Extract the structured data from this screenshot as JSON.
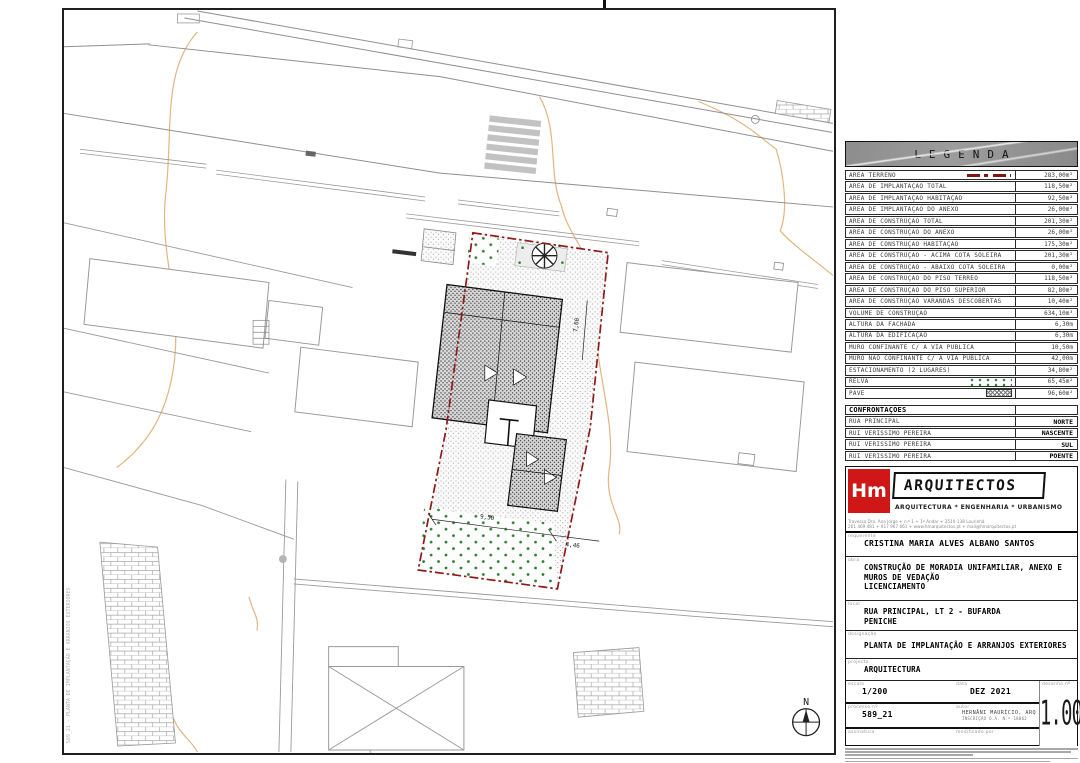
{
  "legend": {
    "title": "LEGENDA",
    "rows": [
      {
        "label": "ÁREA TERRENO",
        "value": "283,00m²",
        "symbol": "red-dashdot"
      },
      {
        "label": "ÁREA DE IMPLANTAÇÃO TOTAL",
        "value": "118,50m²"
      },
      {
        "label": "ÁREA DE IMPLANTAÇÃO HABITAÇÃO",
        "value": "92,50m²"
      },
      {
        "label": "ÁREA DE IMPLANTAÇÃO DO ANEXO",
        "value": "26,00m²"
      },
      {
        "label": "ÁREA DE CONSTRUÇÃO TOTAL",
        "value": "201,30m²"
      },
      {
        "label": "ÁREA DE CONSTRUÇÃO DO ANEXO",
        "value": "26,00m²"
      },
      {
        "label": "ÁREA DE CONSTRUÇÃO HABITAÇÃO",
        "value": "175,30m²"
      },
      {
        "label": "ÁREA DE CONSTRUÇÃO - ACIMA COTA SOLEIRA",
        "value": "201,30m²"
      },
      {
        "label": "ÁREA DE CONSTRUÇÃO - ABAIXO COTA SOLEIRA",
        "value": "0,00m²"
      },
      {
        "label": "ÁREA DE CONSTRUÇÃO DO PISO TÉRREO",
        "value": "118,50m²"
      },
      {
        "label": "ÁREA DE CONSTRUÇÃO DO PISO SUPERIOR",
        "value": "82,80m²"
      },
      {
        "label": "ÁREA DE CONSTRUÇÃO VARANDAS DESCOBERTAS",
        "value": "10,40m²"
      },
      {
        "label": "VOLUME DE CONSTRUÇÃO",
        "value": "634,10m³"
      },
      {
        "label": "ALTURA DA FACHADA",
        "value": "6,30m"
      },
      {
        "label": "ALTURA DA EDIFICAÇÃO",
        "value": "6,30m"
      },
      {
        "label": "MURO CONFINANTE C/ A VIA PÚBLICA",
        "value": "10,50m"
      },
      {
        "label": "MURO NÃO CONFINANTE C/ A VIA PÚBLICA",
        "value": "42,00m"
      },
      {
        "label": "ESTACIONAMENTO (2 LUGARES)",
        "value": "34,80m²"
      },
      {
        "label": "RELVA",
        "value": "65,45m²",
        "symbol": "grass-dots"
      },
      {
        "label": "PAVÊ",
        "value": "96,60m²",
        "symbol": "pave-hatch"
      }
    ]
  },
  "confrontacoes": {
    "title": "CONFRONTAÇÕES",
    "rows": [
      {
        "label": "RUA PRINCIPAL",
        "value": "NORTE"
      },
      {
        "label": "RUI VERISSIMO PEREIRA",
        "value": "NASCENTE"
      },
      {
        "label": "RUI VERISSIMO PEREIRA",
        "value": "SUL"
      },
      {
        "label": "RUI VERISSIMO PEREIRA",
        "value": "POENTE"
      }
    ]
  },
  "firm": {
    "logo_initials": "Hm",
    "name": "ARQUITECTOS",
    "tagline": "ARQUITECTURA * ENGENHARIA * URBANISMO",
    "address_line1": "Travessa Dra. Ana Jorge + n.º 1 + 1º Andar + 2510-138 Lourinhã",
    "address_line2": "261 469 481 + 917 967 661 + www.hmarquitectos.pt + mail@hmarquitectos.pt"
  },
  "title_block": {
    "labels": {
      "requerente": "requerente",
      "obra": "obra",
      "local": "local",
      "designacao": "designação",
      "projecto": "projecto",
      "escala": "escala",
      "data": "data",
      "desenho": "desenho nº",
      "processo": "processo nº",
      "autor": "autor",
      "assinatura": "assinatura",
      "modificado": "modificado por"
    },
    "requerente": "CRISTINA MARIA ALVES ALBANO SANTOS",
    "obra_lines": [
      "CONSTRUÇÃO DE MORADIA UNIFAMILIAR, ANEXO E",
      "MUROS DE VEDAÇÃO",
      "LICENCIAMENTO"
    ],
    "local_lines": [
      "RUA PRINCIPAL, LT 2 - BUFARDA",
      "PENICHE"
    ],
    "designacao": "PLANTA DE IMPLANTAÇÃO E ARRANJOS EXTERIORES",
    "projecto": "ARQUITECTURA",
    "escala": "1/200",
    "data": "DEZ 2021",
    "processo": "589_21",
    "autor_lines": [
      "HERNÂNI MAURÍCIO, ARQ",
      "INSCRIÇÃO O.A. N.º 18062"
    ],
    "desenho_numero": "1.00"
  },
  "plan": {
    "north_label": "N",
    "dims": [
      "9,50",
      "4,46",
      "7,60"
    ],
    "plot_stamp": "589_21 - PLANTA DE IMPLANTAÇÃO E ARRANJOS EXTERIORES"
  }
}
